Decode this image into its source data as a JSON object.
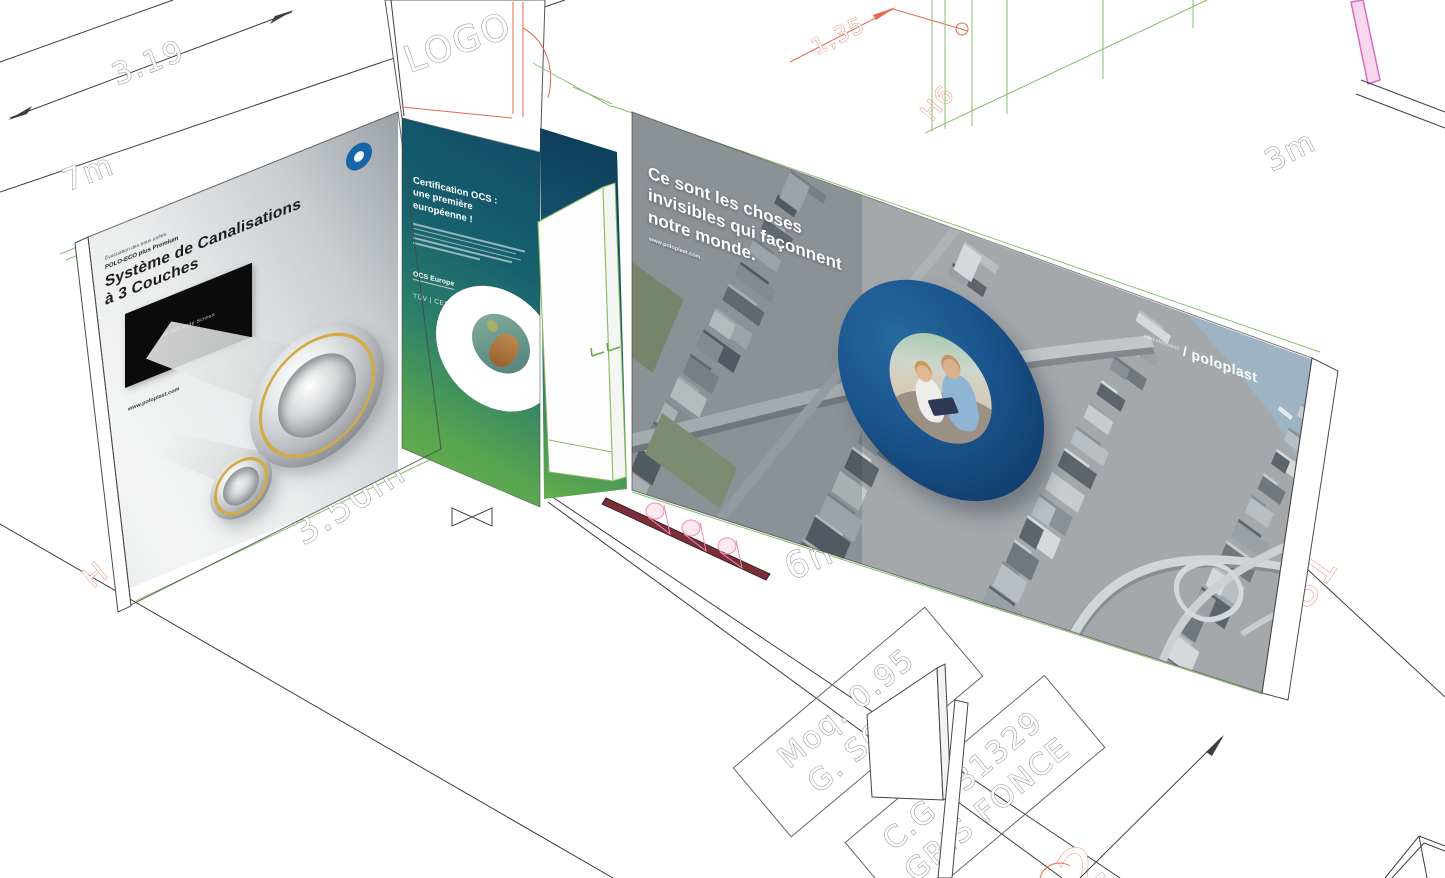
{
  "cad": {
    "dim_319": "3.19",
    "dim_7m": "7m",
    "dim_135": "1,35",
    "dim_h6": "H6",
    "dim_3m": "3m",
    "dim_350m": "3.50m",
    "dim_6m": "6m",
    "logo_placeholder": "LOGO",
    "label_l081": "L081",
    "label_partial_2": "2",
    "label_partial_h": "H",
    "floor_box1_line1": "Moq. 0.95",
    "floor_box1_line2": "G. SOL",
    "floor_box2_line1": "C.G 031329",
    "floor_box2_line2": "GRIS FONCE"
  },
  "left_wall": {
    "tagline_small": "Évacuation des eaux usées",
    "product": "POLO-ECO plus Premium",
    "title1": "Système de Canalisations",
    "title2": "à 3 Couches",
    "screen_label": "40 Zoll Wide Screen",
    "website": "www.poloplast.com",
    "brand_prefix": "PURE PROGRESS /",
    "brand": "poloplast"
  },
  "middle_panel": {
    "heading1": "Certification OCS :",
    "heading2": "une première",
    "heading3": "européenne !",
    "cert1": "OCS Europe",
    "cert2": "TÜV | CES"
  },
  "right_wall": {
    "headline1": "Ce sont les choses",
    "headline2": "invisibles qui façonnent",
    "headline3": "notre monde.",
    "website": "www.poloplast.com",
    "brand_prefix": "PURE PROGRESS",
    "brand": "/ poloplast"
  },
  "colors": {
    "accent_blue": "#1a548c",
    "panel_teal": "#114e66",
    "panel_green": "#6ab34b",
    "cad_red": "#e8694f",
    "cad_green": "#86c06a",
    "cad_pink": "#d86cc0",
    "gold_ring": "#d2ab45"
  }
}
